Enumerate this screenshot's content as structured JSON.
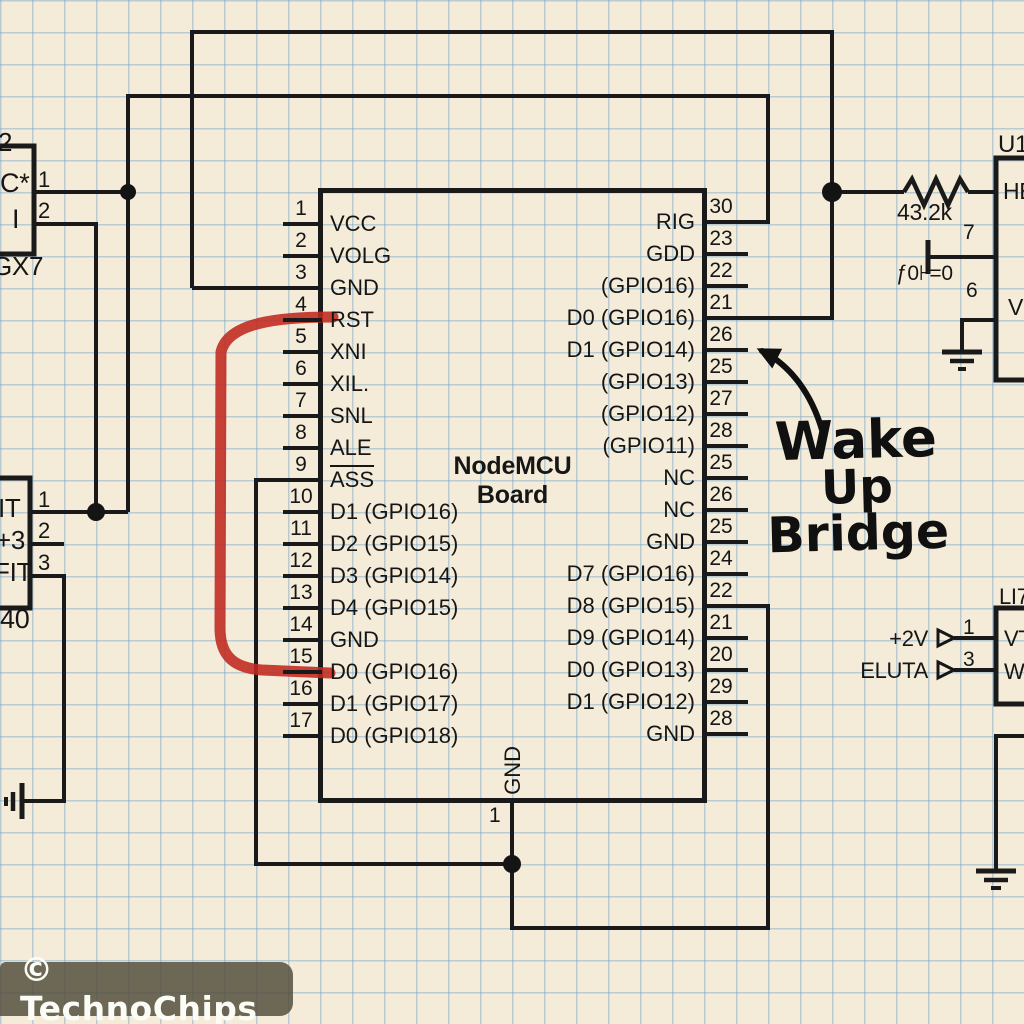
{
  "colors": {
    "paper": "#f4ecd8",
    "grid_blue": "#7eaac7",
    "wire_black": "#1a1a1a",
    "jumper_red": "#c0281f",
    "watermark_bg": "#534f3d",
    "watermark_text": "#fcfcf6"
  },
  "watermark": {
    "text": "© TechnoChips"
  },
  "annotation": {
    "line1": "Wake",
    "line2": "Up",
    "line3": "Bridge"
  },
  "board": {
    "title_line1": "NodeMCU",
    "title_line2": "Board",
    "bottom_pin": {
      "n": "1",
      "label": "GND"
    },
    "left_pins": [
      {
        "n": "1",
        "label": "VCC"
      },
      {
        "n": "2",
        "label": "VOLG"
      },
      {
        "n": "3",
        "label": "GND"
      },
      {
        "n": "4",
        "label": "RST"
      },
      {
        "n": "5",
        "label": "XNI"
      },
      {
        "n": "6",
        "label": "XIL."
      },
      {
        "n": "7",
        "label": "SNL"
      },
      {
        "n": "8",
        "label": "ALE"
      },
      {
        "n": "9",
        "label": "ASS",
        "overline": true
      },
      {
        "n": "10",
        "label": "D1 (GPIO16)"
      },
      {
        "n": "11",
        "label": "D2 (GPIO15)"
      },
      {
        "n": "12",
        "label": "D3 (GPIO14)"
      },
      {
        "n": "13",
        "label": "D4 (GPIO15)"
      },
      {
        "n": "14",
        "label": "GND"
      },
      {
        "n": "15",
        "label": "D0 (GPIO16)"
      },
      {
        "n": "16",
        "label": "D1 (GPIO17)"
      },
      {
        "n": "17",
        "label": "D0 (GPIO18)"
      }
    ],
    "right_pins": [
      {
        "n": "30",
        "label": "RIG"
      },
      {
        "n": "23",
        "label": "GDD"
      },
      {
        "n": "22",
        "label": "(GPIO16)"
      },
      {
        "n": "21",
        "label": "D0 (GPIO16)"
      },
      {
        "n": "26",
        "label": "D1 (GPIO14)"
      },
      {
        "n": "25",
        "label": "(GPIO13)"
      },
      {
        "n": "27",
        "label": "(GPIO12)"
      },
      {
        "n": "28",
        "label": "(GPIO11)"
      },
      {
        "n": "25",
        "label": "NC"
      },
      {
        "n": "26",
        "label": "NC"
      },
      {
        "n": "25",
        "label": "GND"
      },
      {
        "n": "24",
        "label": "D7 (GPIO16)"
      },
      {
        "n": "22",
        "label": "D8 (GPIO15)"
      },
      {
        "n": "21",
        "label": "D9 (GPIO14)"
      },
      {
        "n": "20",
        "label": "D0 (GPIO13)"
      },
      {
        "n": "29",
        "label": "D1 (GPIO12)"
      },
      {
        "n": "28",
        "label": "GND"
      }
    ]
  },
  "components": {
    "resistor": {
      "value": "43.2k"
    },
    "capacitor": {
      "value": "ƒ0⊦=0"
    },
    "u1": {
      "ref": "U1",
      "pin7": "7",
      "pin6": "6",
      "label_top": "HE",
      "label_bottom": "V"
    },
    "li7": {
      "ref": "LI7",
      "pin1": "1",
      "pin3": "3",
      "label1": "VT",
      "label2": "W",
      "sig1": "+2V",
      "sig2": "ELUTA"
    },
    "conn_top_left": {
      "ref": "2",
      "label1": "C*",
      "label2": "I",
      "part": "GX7",
      "pin1": "1",
      "pin2": "2"
    },
    "conn_mid_left": {
      "label1": "IT",
      "label2": "+3",
      "label3": "FIT",
      "part": "40",
      "pin1": "1",
      "pin2": "2",
      "pin3": "3"
    }
  }
}
